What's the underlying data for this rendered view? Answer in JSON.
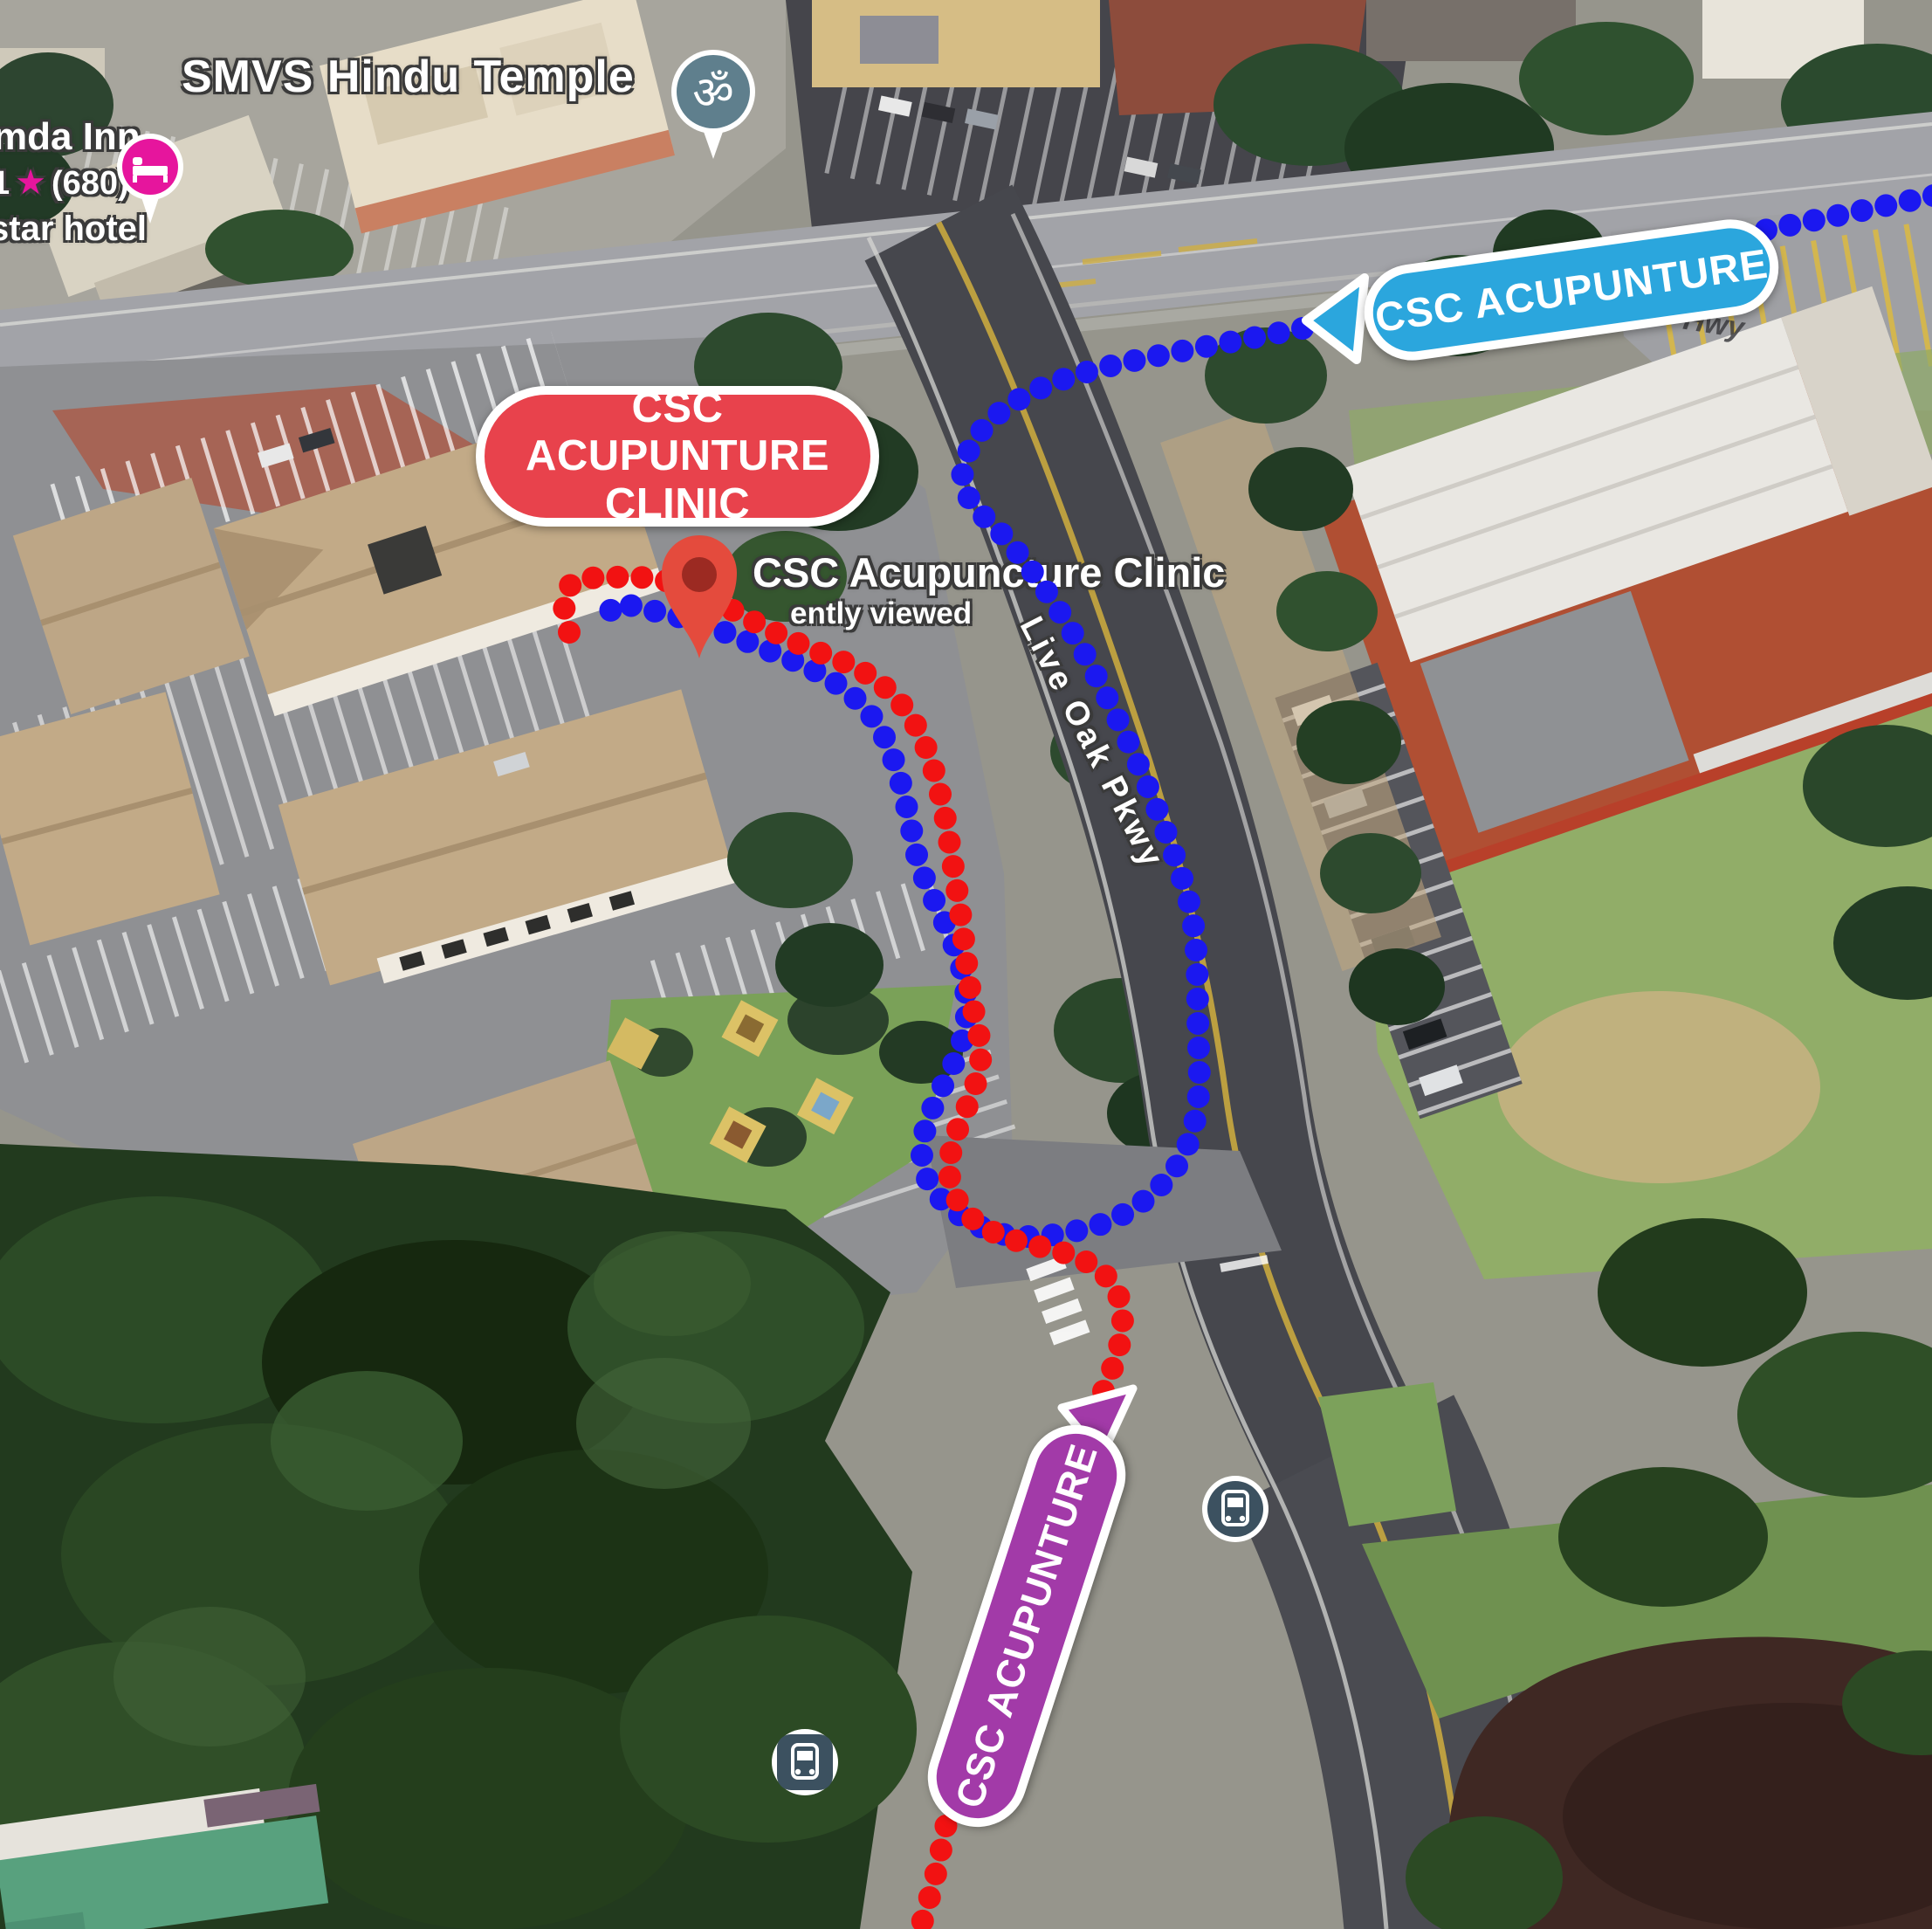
{
  "map": {
    "pois": {
      "temple": {
        "label": "SMVS Hindu Temple"
      },
      "hotel": {
        "name": "mda Inn",
        "rating": "1",
        "reviews": "(680)",
        "category": "star hotel"
      },
      "clinic": {
        "label": "CSC Acupuncture Clinic",
        "status": "ently viewed"
      }
    },
    "roads": {
      "live_oak": "Live Oak Pkwy",
      "hwy_fragment": "Hwy"
    },
    "callouts": {
      "destination": {
        "line1": "CSC ACUPUNTURE",
        "line2": "CLINIC",
        "color": "#e8424c"
      },
      "route_from_east": {
        "label": "CSC ACUPUNTURE",
        "color": "#2ba6dd"
      },
      "route_from_south": {
        "label": "CSC ACUPUNTURE",
        "color": "#a23aa8"
      }
    },
    "routes": {
      "blue_color": "#1b18f0",
      "red_color": "#f21212"
    },
    "icons": {
      "om": "ॐ",
      "star": "★"
    }
  }
}
